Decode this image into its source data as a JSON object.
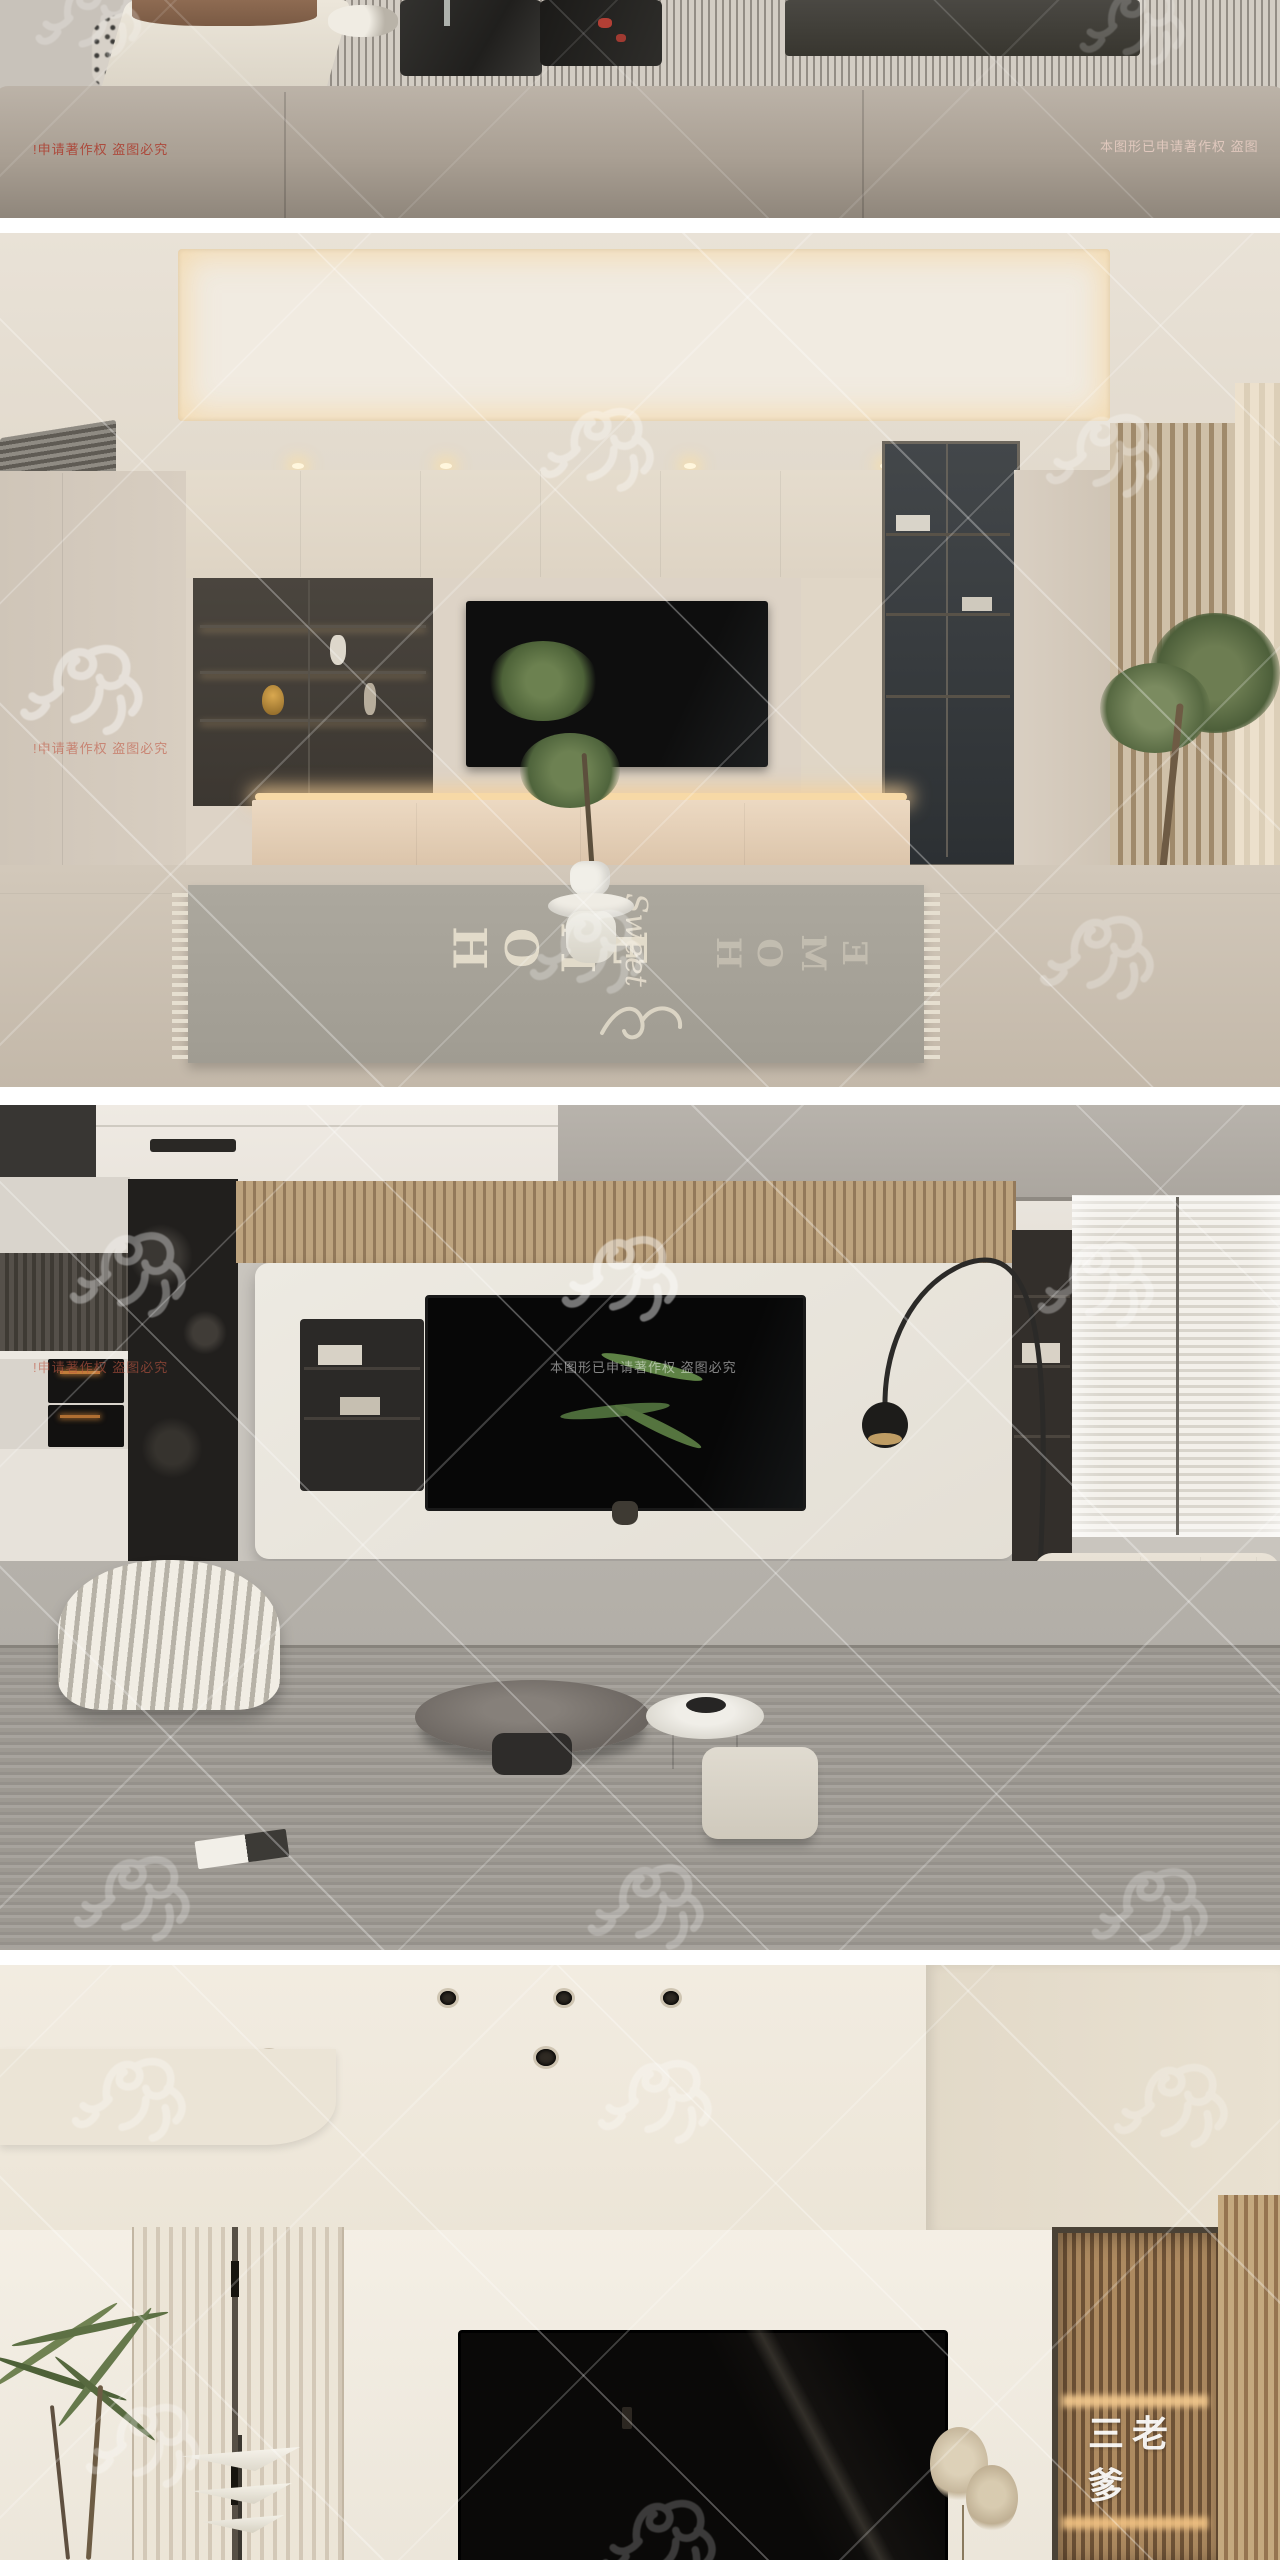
{
  "page": {
    "background": "#ffffff",
    "type": "stacked-interior-render-gallery"
  },
  "watermarks": {
    "copyright_short": "!申请著作权 盗图必究",
    "copyright_full": "本图形已申请著作权 盗图必究",
    "copyright_right_clipped": "本图形已申请著作权 盗图",
    "brand": "三老爹",
    "red_color": "#ac3e30",
    "pale_color": "#eed2c8",
    "white_color": "#ffffff"
  },
  "icons": {
    "horse_watermark": "calligraphy-horse-brush-mark"
  },
  "rug": {
    "home": "HOME",
    "sweet": "Sweet"
  },
  "sections": [
    {
      "label": "cropped living room photo with beige sofa, striped rug and dark coffee table"
    },
    {
      "label": "living room with beige TV cabinet wall, smoked glass display case, slat wall, tree and HOME sweet rug"
    },
    {
      "label": "living room with white TV panel, black rock column, arc floor lamp, striped armchair and window blinds"
    },
    {
      "label": "living room with cream ceiling, slat panels, black TV, ribbed glass cabinet and palm plant"
    }
  ],
  "colors": {
    "warm_glow": "#f3c98e",
    "beige_wall": "#ddd3c6",
    "dark_tv": "#0b0a09",
    "rug_gray": "#a9a59b",
    "wood_slat": "#b99e78"
  }
}
